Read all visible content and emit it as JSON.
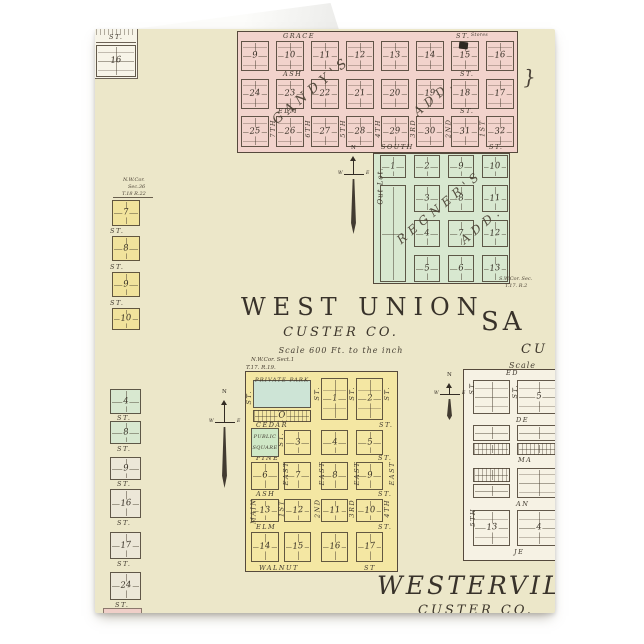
{
  "titles": {
    "west_union": {
      "name": "WEST UNION",
      "county": "CUSTER CO.",
      "scale": "Scale 600 Ft. to the inch"
    },
    "sargent_partial": {
      "name": "SA",
      "county": "CU",
      "scale": "Scale"
    },
    "westerville": {
      "name": "WESTERVILLE",
      "county": "CUSTER CO."
    }
  },
  "compass": {
    "n": "N",
    "w": "W",
    "e": "E"
  },
  "brace_mark": "}",
  "plats": {
    "gandys": {
      "diagonal": [
        "GANDY'S",
        "ADD."
      ],
      "stores_note": "Stores",
      "streets": [
        {
          "name": "GRACE",
          "st": "ST."
        },
        {
          "name": "ASH",
          "st": "ST."
        },
        {
          "name": "ELM",
          "st": "ST."
        },
        {
          "name": "SOUTH",
          "st": "ST."
        }
      ],
      "vertical_streets": [
        "7TH",
        "6TH",
        "5TH",
        "4TH",
        "3RD",
        "2ND",
        "1ST"
      ],
      "rows": [
        [
          "9",
          "10",
          "11",
          "12",
          "13",
          "14",
          "15",
          "16"
        ],
        [
          "24",
          "23",
          "22",
          "21",
          "20",
          "19",
          "18",
          "17"
        ],
        [
          "25",
          "26",
          "27",
          "28",
          "29",
          "30",
          "31",
          "32"
        ]
      ]
    },
    "regners": {
      "diagonal": [
        "REGNER'S",
        "ADD."
      ],
      "out_lot": "Out Lot.",
      "grid": [
        [
          "1",
          "2",
          "9",
          "10"
        ],
        [
          "",
          "3",
          "8",
          "11"
        ],
        [
          "",
          "4",
          "7",
          "12"
        ],
        [
          "",
          "5",
          "6",
          "13"
        ]
      ],
      "corner_note": [
        "S.W.Cor. Sec.",
        "T.17. R.2"
      ]
    },
    "west_union_town": {
      "corner_note": [
        "N.W.Cor. Sect.1",
        "T.17. R.19."
      ],
      "private_park": "PRIVATE PARK",
      "block_o": "O",
      "public_square": [
        "PUBLIC",
        "SQUARE"
      ],
      "streets": [
        {
          "name": "CEDAR",
          "st": "ST."
        },
        {
          "name": "PINE",
          "st": "ST."
        },
        {
          "name": "ASH",
          "st": "ST."
        },
        {
          "name": "ELM",
          "st": "ST."
        },
        {
          "name": "WALNUT",
          "st": "ST"
        }
      ],
      "left_streets": [
        "ST.",
        "MAIN"
      ],
      "top_vertical": [
        "ST.",
        "ST.",
        "ST."
      ],
      "mid_vertical": "ST.",
      "east_streets": [
        "EAST",
        "EAST",
        "EAST",
        "EAST"
      ],
      "numbered_vertical": [
        "1ST",
        "2ND",
        "3RD",
        "4TH"
      ],
      "rows": {
        "r1": [
          "1",
          "2"
        ],
        "r2": [
          "3",
          "4",
          "5"
        ],
        "r3": [
          "6",
          "7",
          "8",
          "9"
        ],
        "r4": [
          "13",
          "12",
          "11",
          "10"
        ],
        "r5": [
          "14",
          "15",
          "16",
          "17"
        ]
      }
    },
    "left_top": {
      "st": "ST.",
      "block": "16"
    },
    "left_yellow": {
      "corner_note": [
        "N.W.Cor.",
        "Sec.36",
        "T.18 R.22"
      ],
      "street": "ST.",
      "blocks": [
        "7",
        "8",
        "9",
        "10"
      ]
    },
    "left_lower": {
      "street": "ST.",
      "green_blocks": [
        "4",
        "8"
      ],
      "gray_blocks": [
        "9",
        "16",
        "17",
        "24"
      ]
    },
    "sargent": {
      "streets": [
        "ED",
        "DE",
        "MA",
        "AN",
        "JE"
      ],
      "vertical_streets": [
        "ST.",
        "ST.",
        "5TH"
      ],
      "numbers": [
        "5",
        "13",
        "4"
      ]
    }
  }
}
